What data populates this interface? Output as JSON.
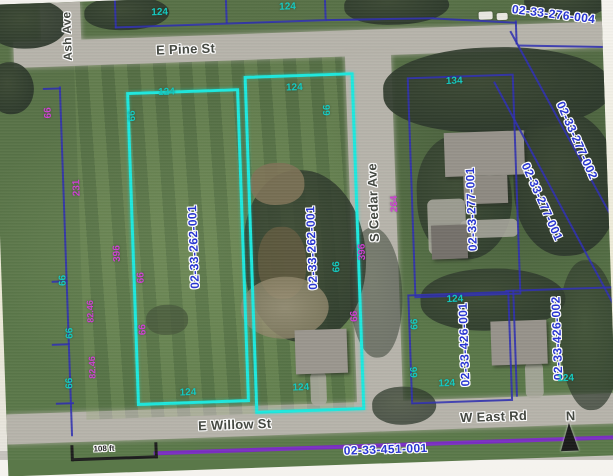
{
  "screen": {
    "type": "gis-parcel-viewer-aerial-photo"
  },
  "streets": {
    "ash": "Ash Ave",
    "pine": "E Pine St",
    "cedar": "S Cedar Ave",
    "willow": "E Willow St",
    "east": "W East Rd"
  },
  "parcels": {
    "p276_004": {
      "id": "02-33-276-004",
      "selected": false
    },
    "p262_001_left": {
      "id": "02-33-262-001",
      "selected": true
    },
    "p262_001_center": {
      "id": "02-33-262-001",
      "selected": true
    },
    "p277_001": {
      "id": "02-33-277-001",
      "selected": false
    },
    "p277_002_diag": {
      "id": "02-33-277-002",
      "selected": false
    },
    "p277_001_diag": {
      "id": "02-33-277-001",
      "selected": false
    },
    "p426_001": {
      "id": "02-33-426-001",
      "selected": false
    },
    "p426_002": {
      "id": "02-33-426-002",
      "selected": false
    },
    "p451_001": {
      "id": "02-33-451-001",
      "selected": false
    }
  },
  "dims": [
    {
      "text": "124"
    },
    {
      "text": "124"
    },
    {
      "text": "124"
    },
    {
      "text": "66"
    },
    {
      "text": "124"
    },
    {
      "text": "66"
    },
    {
      "text": "134"
    },
    {
      "text": "66"
    },
    {
      "text": "231"
    },
    {
      "text": "396"
    },
    {
      "text": "66"
    },
    {
      "text": "66"
    },
    {
      "text": "82.46"
    },
    {
      "text": "82.46"
    },
    {
      "text": "66"
    },
    {
      "text": "66"
    },
    {
      "text": "66"
    },
    {
      "text": "66"
    },
    {
      "text": "396"
    },
    {
      "text": "264"
    },
    {
      "text": "66"
    },
    {
      "text": "124"
    },
    {
      "text": "124"
    },
    {
      "text": "124"
    },
    {
      "text": "66"
    },
    {
      "text": "66"
    },
    {
      "text": "124"
    },
    {
      "text": "124"
    }
  ],
  "scale": {
    "label": "108 ft"
  },
  "north": {
    "label": "N"
  },
  "colors": {
    "selected_parcel_cyan": "#1ce8de",
    "boundary_navy": "#2f2fb0",
    "parcel_id_blue": "#2633d2",
    "dimension_teal": "#12c9c0",
    "dimension_magenta": "#cf3ed4",
    "section_line_purple": "#7a2ec2"
  }
}
